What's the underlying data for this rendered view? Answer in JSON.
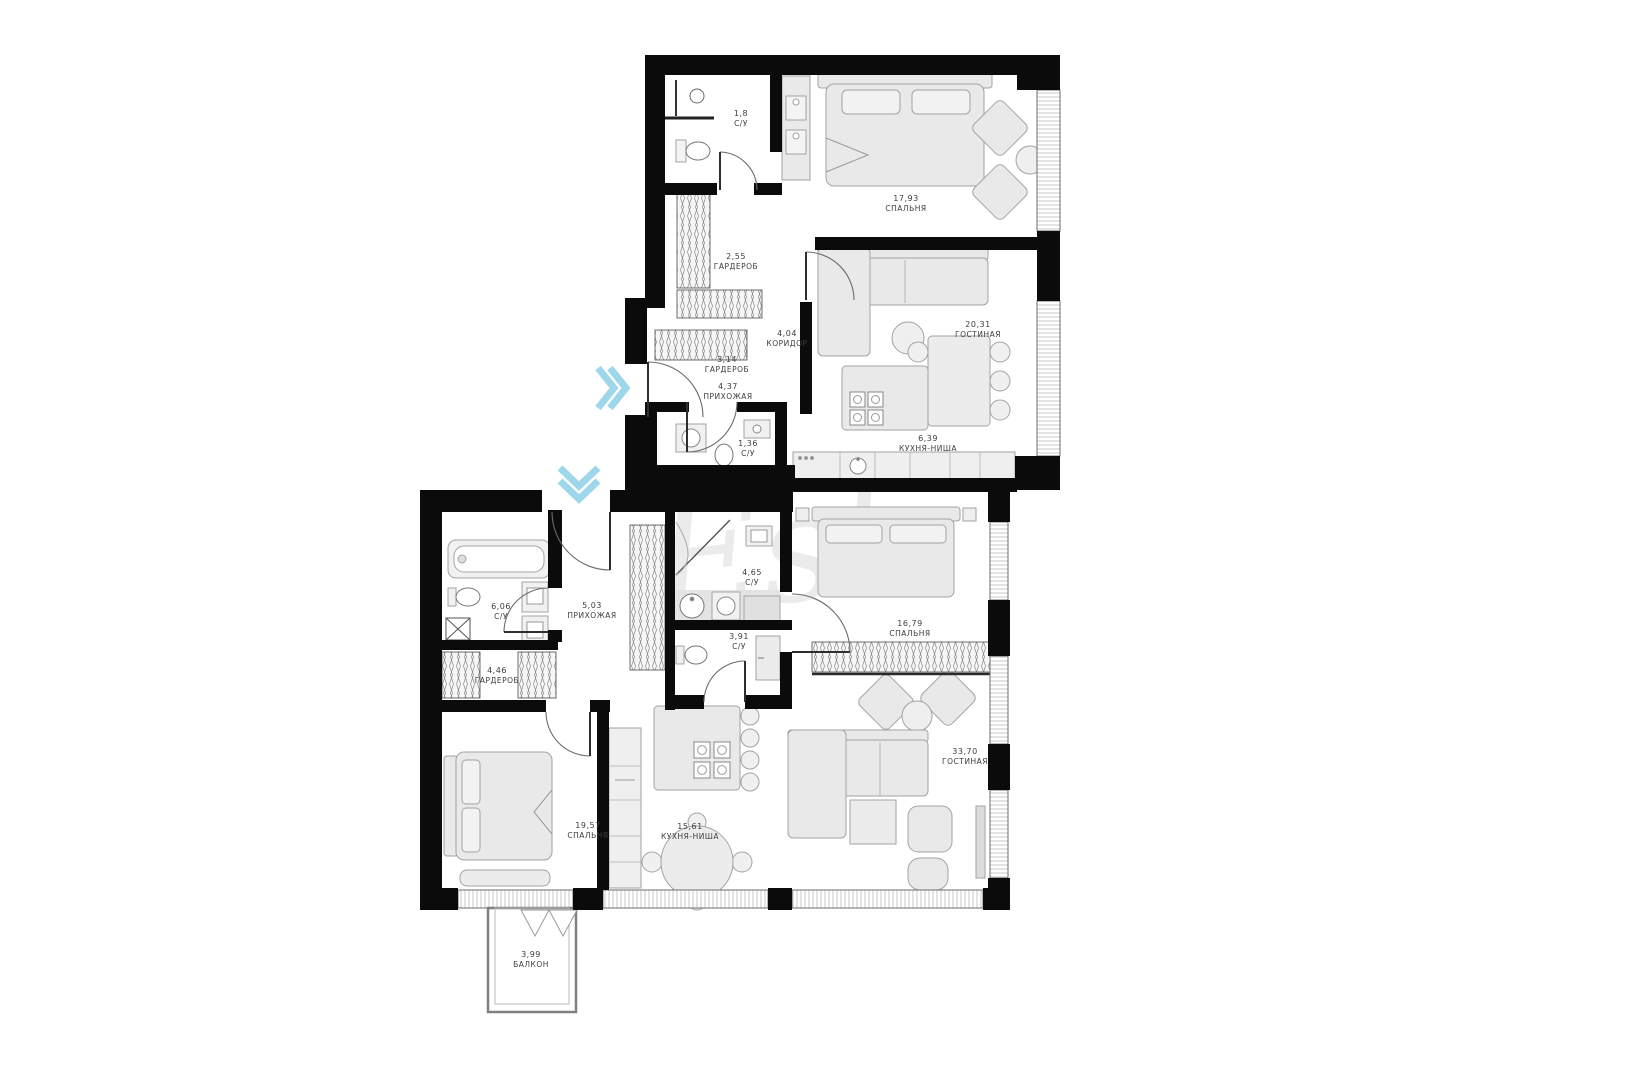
{
  "watermark": "Est.",
  "colors": {
    "wall": "#0b0b0b",
    "furniture_fill": "#e9e9e9",
    "furniture_stroke": "#a3a3a3",
    "accent_arrow": "#9ed7eb",
    "label_text": "#3d3d3d"
  },
  "rooms": [
    {
      "id": "su-top",
      "area": "1,8",
      "name": "С/У"
    },
    {
      "id": "bedroom-top",
      "area": "17,93",
      "name": "СПАЛЬНЯ"
    },
    {
      "id": "wardrobe-top",
      "area": "2,55",
      "name": "ГАРДЕРОБ"
    },
    {
      "id": "corridor",
      "area": "4,04",
      "name": "КОРИДОР"
    },
    {
      "id": "living-top",
      "area": "20,31",
      "name": "ГОСТИНАЯ"
    },
    {
      "id": "wardrobe-small",
      "area": "3,14",
      "name": "ГАРДЕРОБ"
    },
    {
      "id": "hall-top",
      "area": "4,37",
      "name": "ПРИХОЖАЯ"
    },
    {
      "id": "su-136",
      "area": "1,36",
      "name": "С/У"
    },
    {
      "id": "kitchen-top",
      "area": "6,39",
      "name": "КУХНЯ-НИША"
    },
    {
      "id": "su-606",
      "area": "6,06",
      "name": "С/У"
    },
    {
      "id": "hall-bottom",
      "area": "5,03",
      "name": "ПРИХОЖАЯ"
    },
    {
      "id": "su-465",
      "area": "4,65",
      "name": "С/У"
    },
    {
      "id": "su-391",
      "area": "3,91",
      "name": "С/У"
    },
    {
      "id": "bedroom-mid",
      "area": "16,79",
      "name": "СПАЛЬНЯ"
    },
    {
      "id": "wardrobe-bottom",
      "area": "4,46",
      "name": "ГАРДЕРОБ"
    },
    {
      "id": "bedroom-bottom",
      "area": "19,57",
      "name": "СПАЛЬНЯ"
    },
    {
      "id": "kitchen-bottom",
      "area": "15,61",
      "name": "КУХНЯ-НИША"
    },
    {
      "id": "living-bottom",
      "area": "33,70",
      "name": "ГОСТИНАЯ"
    },
    {
      "id": "balcony",
      "area": "3,99",
      "name": "БАЛКОН"
    }
  ]
}
